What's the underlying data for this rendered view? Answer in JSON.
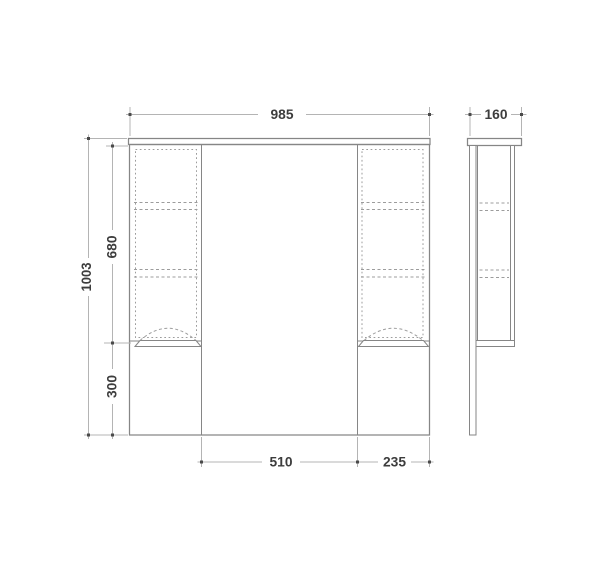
{
  "colors": {
    "background": "#ffffff",
    "line": "#868686",
    "line-light": "#9c9c9c",
    "dimension": "#b4b4b4",
    "tick": "#4a4a4a",
    "text": "#3d3d3d"
  },
  "dimensions": {
    "front_width": "985",
    "side_depth": "160",
    "total_height": "1003",
    "upper_section_height": "680",
    "lower_section_height": "300",
    "center_section_width": "510",
    "right_section_width": "235"
  }
}
